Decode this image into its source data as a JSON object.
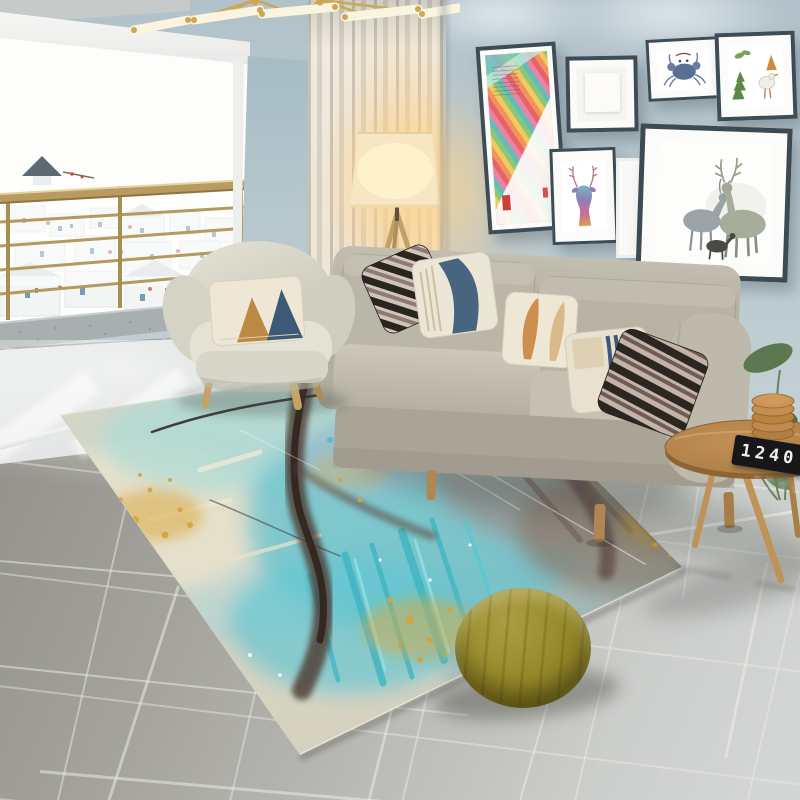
{
  "scene": {
    "description": "Bright modern living room with balcony view of a white village, gallery wall, gray fabric sofa, sage armchair, abstract teal-and-gold art rug, olive pouf and round wooden side table",
    "style": "interior photo"
  },
  "palette": {
    "wall": "#bac9d0",
    "balcony_light": "#fdfdfc",
    "curtain": "#e7e1d4",
    "floor": "#a8a6a0",
    "rug_teal": "#5fc3cd",
    "rug_cream": "#e8e0cb",
    "rug_brown": "#4c382f",
    "rug_gold": "#d3a43c",
    "sofa": "#b7b3a5",
    "armchair": "#dcdbcd",
    "pouf": "#948627",
    "wood": "#bf9257",
    "frame": "#3e4c55",
    "lamp_glow": "#ffd896",
    "railing_brass": "#b99a60"
  },
  "objects": {
    "ceiling_lamp": {
      "label": "gold linear chandelier"
    },
    "balcony": {
      "label": "balcony railing over white village view",
      "landmark": "windmill silhouette"
    },
    "curtain": {
      "label": "sheer beige curtain"
    },
    "floor_lamp": {
      "label": "lit tripod floor lamp"
    },
    "armchair": {
      "label": "sage fabric armchair",
      "pillow": "cream pillow with tan and navy triangles"
    },
    "sofa": {
      "label": "three-seat gray fabric sofa",
      "pillows": [
        "black and mauve diagonal stripes",
        "cream with navy brush shape",
        "cream with rust leaf strokes",
        "cream with navy pinstripe block",
        "black and taupe wide stripes"
      ]
    },
    "rug": {
      "label": "abstract watercolor rug in teal, cream, brown and gold"
    },
    "pouf": {
      "label": "olive green round pouf"
    },
    "side_table": {
      "label": "round wooden tripod side table",
      "book_spine_text": "1240",
      "items": [
        "black clock book",
        "stacked wooden coasters"
      ]
    },
    "plant": {
      "label": "green leafy plant"
    },
    "gallery": {
      "frames": [
        "colorful diagonal geometric print",
        "blank white print",
        "blue crab illustration",
        "green trees and bird illustration",
        "rainbow deer head print",
        "small blank white frame",
        "two watercolor deer with fawn"
      ]
    }
  }
}
